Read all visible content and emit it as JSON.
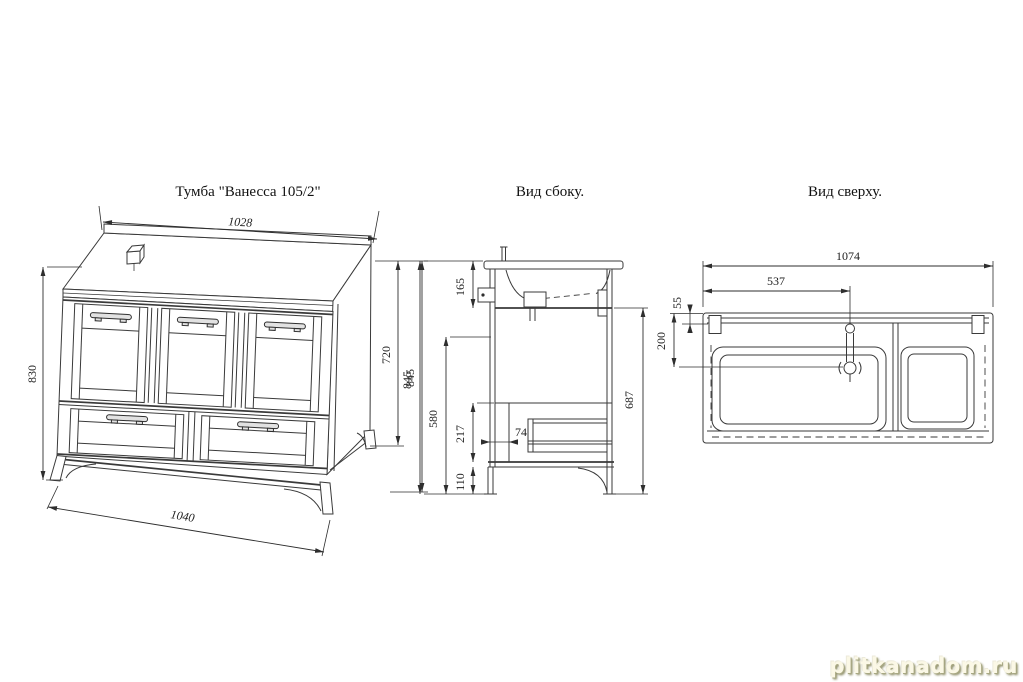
{
  "page": {
    "background": "#ffffff",
    "line_color": "#3a3a3a",
    "watermark": "plitkanadom.ru"
  },
  "front_view": {
    "title": "Тумба \"Ванесса 105/2\"",
    "dim_top_width": "1028",
    "dim_left_height": "830",
    "dim_body_height": "720",
    "dim_total_height": "845",
    "dim_bottom_width": "1040"
  },
  "side_view": {
    "title": "Вид сбоку.",
    "dim_total_height": "845",
    "dim_sink_zone": "165",
    "dim_front_height": "580",
    "dim_drawer_zone": "217",
    "dim_leg_height": "110",
    "dim_back_gap": "74",
    "dim_inner_height": "687"
  },
  "top_view": {
    "title": "Вид сверху.",
    "dim_total_width": "1074",
    "dim_faucet_center": "537",
    "dim_back_rail": "55",
    "dim_drain_offset": "200"
  }
}
